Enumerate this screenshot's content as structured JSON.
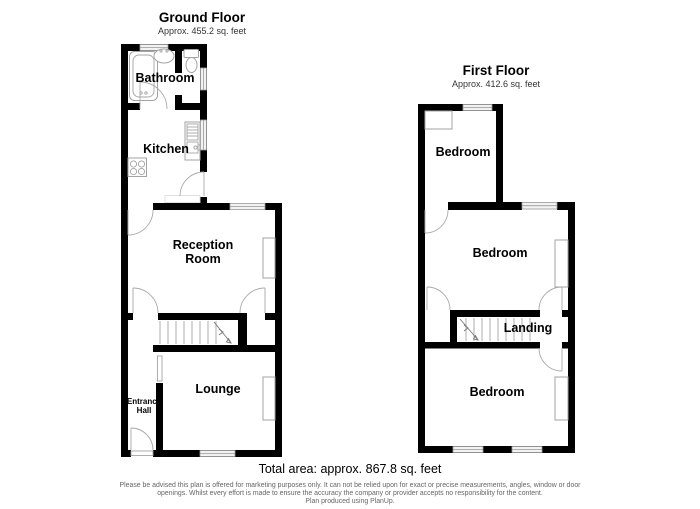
{
  "ground_floor": {
    "title": "Ground Floor",
    "subtitle": "Approx. 455.2 sq. feet",
    "rooms": [
      {
        "label": "Bathroom"
      },
      {
        "label": "Kitchen"
      },
      {
        "label": "Reception\nRoom"
      },
      {
        "label": "Lounge"
      },
      {
        "label": "Entrance\nHall"
      }
    ]
  },
  "first_floor": {
    "title": "First Floor",
    "subtitle": "Approx. 412.6 sq. feet",
    "rooms": [
      {
        "label": "Bedroom"
      },
      {
        "label": "Bedroom"
      },
      {
        "label": "Landing"
      },
      {
        "label": "Bedroom"
      }
    ]
  },
  "footer": {
    "total_area": "Total area: approx. 867.8 sq. feet",
    "disclaimer_line1": "Please be advised this plan is offered for marketing purposes only. It can not be relied upon for exact or precise measurements, angles, window or door",
    "disclaimer_line2": "openings. Whilst every effort is made to ensure the accuracy the company or provider accepts no responsibility for the content.",
    "credit": "Plan produced using PlanUp."
  },
  "colors": {
    "wall": "#000000",
    "fixture_outline": "#a3a3a3",
    "window_fill": "#f2f2f2",
    "muted_text": "#666666"
  }
}
